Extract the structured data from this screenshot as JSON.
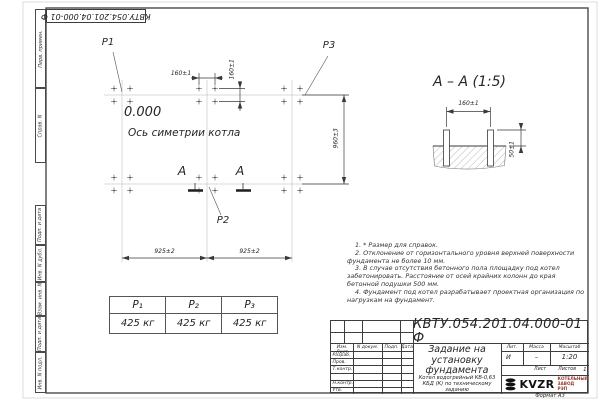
{
  "top_stamp": {
    "text": "КВТУ.054.201.04.000-01 Ф"
  },
  "margin_labels": [
    "Перв. примен.",
    "Справ. N",
    "Подп. и дата",
    "Инв. N дубл.",
    "Взам. инв. N",
    "Подп. и дата",
    "Инв. N подл."
  ],
  "plan": {
    "p1": "P1",
    "p2": "P2",
    "p3": "P3",
    "level": "0.000",
    "axis": "Ось симетрии котла",
    "section_letter": "А",
    "dim_160h": "160±1",
    "dim_160v": "160±1",
    "dim_960": "960±3",
    "dim_925a": "925±2",
    "dim_925b": "925±2"
  },
  "section": {
    "title": "А – А (1:5)",
    "dim_160": "160±1",
    "dim_50": "50±1"
  },
  "loads": {
    "headers": [
      "P₁",
      "P₂",
      "P₃"
    ],
    "values": [
      "425 кг",
      "425 кг",
      "425 кг"
    ]
  },
  "notes": [
    "1. * Размер для справок.",
    "2. Отклонение от горизонтального уровня верхней поверхности фундамента не более 10 мм.",
    "3. В случае отсутствия бетонного пола площадку под котел забетонировать. Расстояние от осей крайних колонн до края бетонной подушки 500 мм.",
    "4. Фундамент под котел разрабатывает проектная организация по нагрузкам на фундамент."
  ],
  "title_block": {
    "designation": "КВТУ.054.201.04.000-01 Ф",
    "doc_title": "Задание на установку фундамента",
    "product": "Котел водогрейный КВ-0,63 КБД (К) по техническому заданию",
    "cols": {
      "izm": "Изм. Лист",
      "doc": "N докум.",
      "sign": "Подп.",
      "date": "Дата"
    },
    "rows": [
      "Разраб.",
      "Пров.",
      "Т.контр.",
      "",
      "Н.контр.",
      "Утв."
    ],
    "lit_label": "Лит.",
    "lit": "И",
    "mass_label": "Масса",
    "mass": "–",
    "scale_label": "Масштаб",
    "scale": "1:20",
    "sheet_label": "Лист",
    "sheets_label": "Листов",
    "sheets": "1",
    "logo": "KVZR",
    "logo_caption": "КОТЕЛЬНЫЙ ЗАВОД РЭП",
    "format": "Формат А3"
  }
}
